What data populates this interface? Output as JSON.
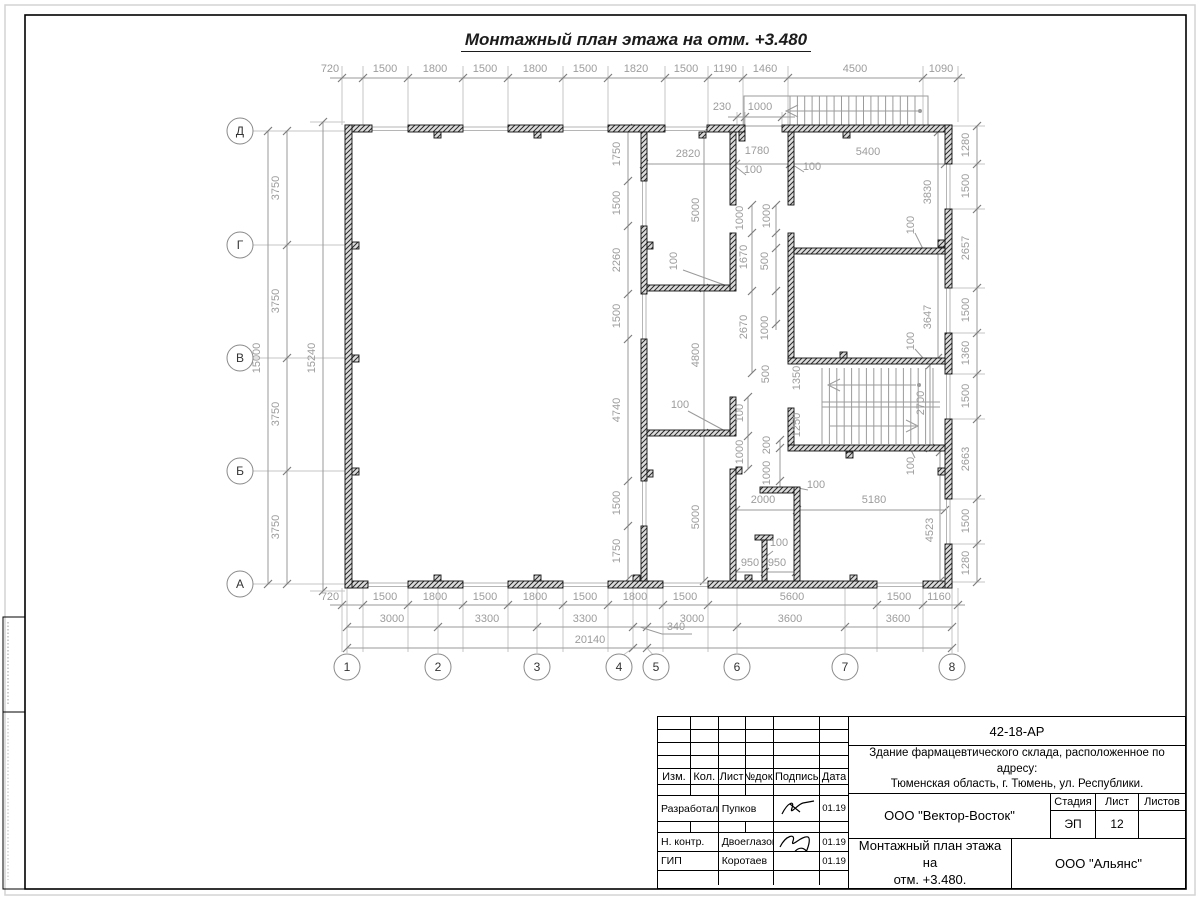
{
  "page": {
    "title": "Монтажный план этажа на отм. +3.480"
  },
  "plan": {
    "axes_cols": [
      {
        "label": "1",
        "x": 347
      },
      {
        "label": "2",
        "x": 438
      },
      {
        "label": "3",
        "x": 537
      },
      {
        "label": "4",
        "x": 619
      },
      {
        "label": "5",
        "x": 656
      },
      {
        "label": "6",
        "x": 737
      },
      {
        "label": "7",
        "x": 845
      },
      {
        "label": "8",
        "x": 952
      }
    ],
    "axes_rows": [
      {
        "label": "Д",
        "y": 131
      },
      {
        "label": "Г",
        "y": 245
      },
      {
        "label": "В",
        "y": 358
      },
      {
        "label": "Б",
        "y": 471
      },
      {
        "label": "А",
        "y": 584
      }
    ],
    "dims": [
      {
        "t": "720",
        "x": 330,
        "y": 72
      },
      {
        "t": "1500",
        "x": 385,
        "y": 72
      },
      {
        "t": "1800",
        "x": 435,
        "y": 72
      },
      {
        "t": "1500",
        "x": 485,
        "y": 72
      },
      {
        "t": "1800",
        "x": 535,
        "y": 72
      },
      {
        "t": "1500",
        "x": 585,
        "y": 72
      },
      {
        "t": "1820",
        "x": 636,
        "y": 72
      },
      {
        "t": "1500",
        "x": 686,
        "y": 72
      },
      {
        "t": "1190",
        "x": 725,
        "y": 72
      },
      {
        "t": "1460",
        "x": 765,
        "y": 72
      },
      {
        "t": "4500",
        "x": 855,
        "y": 72
      },
      {
        "t": "1090",
        "x": 941,
        "y": 72
      },
      {
        "t": "230",
        "x": 722,
        "y": 110
      },
      {
        "t": "1000",
        "x": 760,
        "y": 110
      },
      {
        "t": "720",
        "x": 330,
        "y": 600
      },
      {
        "t": "1500",
        "x": 385,
        "y": 600
      },
      {
        "t": "1800",
        "x": 435,
        "y": 600
      },
      {
        "t": "1500",
        "x": 485,
        "y": 600
      },
      {
        "t": "1800",
        "x": 535,
        "y": 600
      },
      {
        "t": "1500",
        "x": 585,
        "y": 600
      },
      {
        "t": "1800",
        "x": 635,
        "y": 600
      },
      {
        "t": "1500",
        "x": 685,
        "y": 600
      },
      {
        "t": "5600",
        "x": 792,
        "y": 600
      },
      {
        "t": "1500",
        "x": 899,
        "y": 600
      },
      {
        "t": "1160",
        "x": 939,
        "y": 600
      },
      {
        "t": "3000",
        "x": 392,
        "y": 622
      },
      {
        "t": "3300",
        "x": 487,
        "y": 622
      },
      {
        "t": "3300",
        "x": 585,
        "y": 622
      },
      {
        "t": "340",
        "x": 676,
        "y": 630
      },
      {
        "t": "3000",
        "x": 692,
        "y": 622
      },
      {
        "t": "3600",
        "x": 790,
        "y": 622
      },
      {
        "t": "3600",
        "x": 898,
        "y": 622
      },
      {
        "t": "20140",
        "x": 590,
        "y": 643
      },
      {
        "t": "3750",
        "x": 279,
        "y": 188,
        "r": 1
      },
      {
        "t": "3750",
        "x": 279,
        "y": 301,
        "r": 1
      },
      {
        "t": "3750",
        "x": 279,
        "y": 414,
        "r": 1
      },
      {
        "t": "3750",
        "x": 279,
        "y": 527,
        "r": 1
      },
      {
        "t": "15000",
        "x": 260,
        "y": 358,
        "r": 1
      },
      {
        "t": "15240",
        "x": 315,
        "y": 358,
        "r": 1
      },
      {
        "t": "1280",
        "x": 969,
        "y": 145,
        "r": 1
      },
      {
        "t": "1500",
        "x": 969,
        "y": 186,
        "r": 1
      },
      {
        "t": "2657",
        "x": 969,
        "y": 248,
        "r": 1
      },
      {
        "t": "1500",
        "x": 969,
        "y": 310,
        "r": 1
      },
      {
        "t": "1360",
        "x": 969,
        "y": 353,
        "r": 1
      },
      {
        "t": "1500",
        "x": 969,
        "y": 396,
        "r": 1
      },
      {
        "t": "2663",
        "x": 969,
        "y": 459,
        "r": 1
      },
      {
        "t": "1500",
        "x": 969,
        "y": 521,
        "r": 1
      },
      {
        "t": "1280",
        "x": 969,
        "y": 563,
        "r": 1
      },
      {
        "t": "1750",
        "x": 620,
        "y": 154,
        "r": 1
      },
      {
        "t": "1500",
        "x": 620,
        "y": 203,
        "r": 1
      },
      {
        "t": "2260",
        "x": 620,
        "y": 260,
        "r": 1
      },
      {
        "t": "1500",
        "x": 620,
        "y": 316,
        "r": 1
      },
      {
        "t": "4740",
        "x": 620,
        "y": 410,
        "r": 1
      },
      {
        "t": "1500",
        "x": 620,
        "y": 503,
        "r": 1
      },
      {
        "t": "1750",
        "x": 620,
        "y": 551,
        "r": 1
      },
      {
        "t": "5000",
        "x": 699,
        "y": 210,
        "r": 1
      },
      {
        "t": "4800",
        "x": 699,
        "y": 355,
        "r": 1
      },
      {
        "t": "5000",
        "x": 699,
        "y": 517,
        "r": 1
      },
      {
        "t": "2820",
        "x": 688,
        "y": 157
      },
      {
        "t": "1780",
        "x": 757,
        "y": 154
      },
      {
        "t": "5400",
        "x": 868,
        "y": 155
      },
      {
        "t": "100",
        "x": 753,
        "y": 173
      },
      {
        "t": "100",
        "x": 812,
        "y": 170
      },
      {
        "t": "1000",
        "x": 743,
        "y": 218,
        "r": 1
      },
      {
        "t": "1670",
        "x": 747,
        "y": 257,
        "r": 1
      },
      {
        "t": "2670",
        "x": 747,
        "y": 327,
        "r": 1
      },
      {
        "t": "1000",
        "x": 770,
        "y": 216,
        "r": 1
      },
      {
        "t": "500",
        "x": 768,
        "y": 261,
        "r": 1
      },
      {
        "t": "1000",
        "x": 768,
        "y": 328,
        "r": 1
      },
      {
        "t": "100",
        "x": 677,
        "y": 261,
        "r": 1
      },
      {
        "t": "100",
        "x": 680,
        "y": 408
      },
      {
        "t": "100",
        "x": 743,
        "y": 413,
        "r": 1
      },
      {
        "t": "1000",
        "x": 743,
        "y": 452,
        "r": 1
      },
      {
        "t": "200",
        "x": 770,
        "y": 445,
        "r": 1
      },
      {
        "t": "1000",
        "x": 770,
        "y": 473,
        "r": 1
      },
      {
        "t": "100",
        "x": 779,
        "y": 546
      },
      {
        "t": "950",
        "x": 750,
        "y": 566
      },
      {
        "t": "950",
        "x": 777,
        "y": 566
      },
      {
        "t": "2000",
        "x": 763,
        "y": 503
      },
      {
        "t": "5180",
        "x": 874,
        "y": 503
      },
      {
        "t": "100",
        "x": 816,
        "y": 488
      },
      {
        "t": "500",
        "x": 769,
        "y": 374,
        "r": 1
      },
      {
        "t": "1350",
        "x": 800,
        "y": 378,
        "r": 1
      },
      {
        "t": "1250",
        "x": 800,
        "y": 425,
        "r": 1
      },
      {
        "t": "2700",
        "x": 924,
        "y": 403,
        "r": 1
      },
      {
        "t": "100",
        "x": 914,
        "y": 466,
        "r": 1
      },
      {
        "t": "4523",
        "x": 933,
        "y": 530,
        "r": 1
      },
      {
        "t": "3830",
        "x": 931,
        "y": 192,
        "r": 1
      },
      {
        "t": "100",
        "x": 914,
        "y": 225,
        "r": 1
      },
      {
        "t": "3647",
        "x": 931,
        "y": 317,
        "r": 1
      },
      {
        "t": "100",
        "x": 914,
        "y": 341,
        "r": 1
      }
    ]
  },
  "titleblock": {
    "doc_number": "42-18-АР",
    "project_line1": "Здание фармацевтического склада, расположенное по адресу:",
    "project_line2": "Тюменская область, г. Тюмень, ул. Республики.",
    "org": "ООО \"Вектор-Восток\"",
    "sheet_title_line1": "Монтажный план этажа на",
    "sheet_title_line2": "отм. +3.480.",
    "company": "ООО \"Альянс\"",
    "cols": [
      "Изм.",
      "Кол.",
      "Лист",
      "№док.",
      "Подпись",
      "Дата"
    ],
    "stage_label": "Стадия",
    "sheet_label": "Лист",
    "sheets_label": "Листов",
    "stage": "ЭП",
    "sheet_no": "12",
    "sheets_total": "",
    "rows": [
      {
        "role": "Разработал",
        "name": "Пупков",
        "date": "01.19"
      },
      {
        "role": "Н. контр.",
        "name": "Двоеглазов",
        "date": "01.19"
      },
      {
        "role": "ГИП",
        "name": "Коротаев",
        "date": "01.19"
      }
    ]
  }
}
